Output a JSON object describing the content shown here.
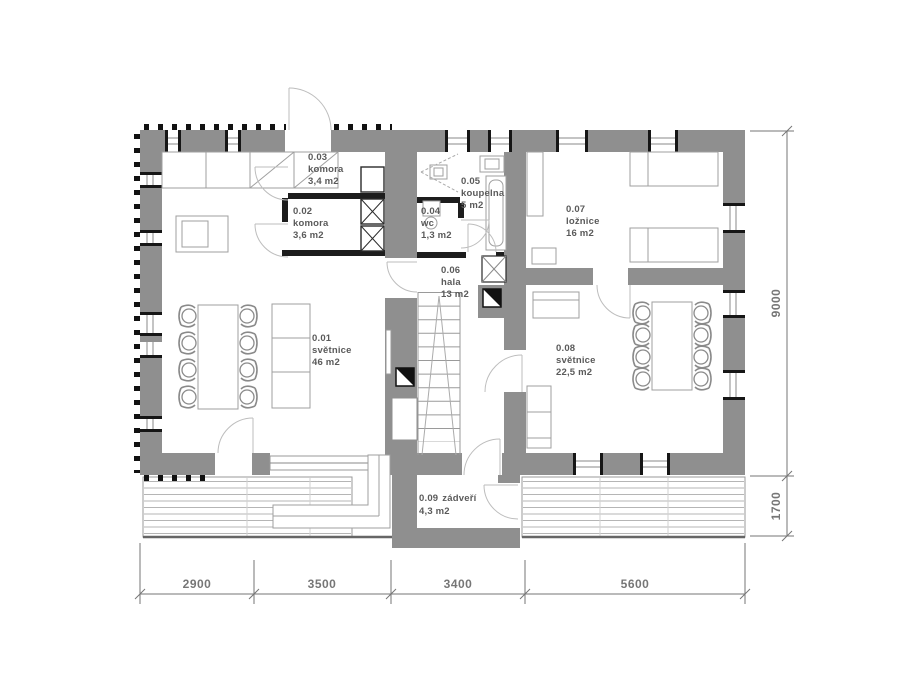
{
  "rooms": [
    {
      "id": "0.01",
      "name": "světnice",
      "area": "46 m2"
    },
    {
      "id": "0.02",
      "name": "komora",
      "area": "3,6 m2"
    },
    {
      "id": "0.03",
      "name": "komora",
      "area": "3,4 m2"
    },
    {
      "id": "0.04",
      "name": "wc",
      "area": "1,3 m2"
    },
    {
      "id": "0.05",
      "name": "koupelna",
      "area": "5 m2"
    },
    {
      "id": "0.06",
      "name": "hala",
      "area": "13 m2"
    },
    {
      "id": "0.07",
      "name": "ložnice",
      "area": "16 m2"
    },
    {
      "id": "0.08",
      "name": "světnice",
      "area": "22,5 m2"
    },
    {
      "id": "0.09",
      "name": "zádveří",
      "area": "4,3 m2"
    }
  ],
  "dimensions": {
    "bottom": [
      "2900",
      "3500",
      "3400",
      "5600"
    ],
    "right": [
      "9000",
      "1700"
    ]
  },
  "colors": {
    "wall": "#8f8f8f",
    "interior_wall": "#1d1d1d",
    "dimension": "#767676",
    "label": "#5a5a5a"
  }
}
